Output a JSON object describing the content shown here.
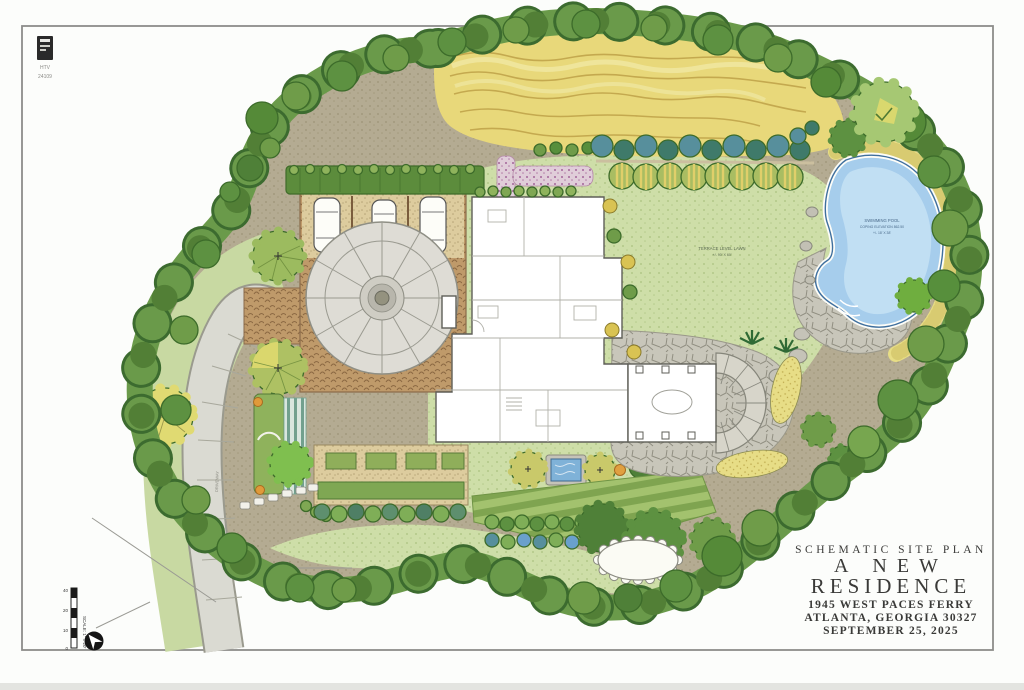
{
  "document": {
    "kind": "hand-rendered schematic landscape site plan",
    "paper_color": "#fcfdfb"
  },
  "stamp": {
    "firm": "HTV",
    "number": "24109"
  },
  "title_block": {
    "kicker": "SCHEMATIC SITE PLAN",
    "title_line1": "A NEW",
    "title_line2": "RESIDENCE",
    "address_line1": "1945 WEST PACES FERRY",
    "address_line2": "ATLANTA, GEORGIA 30327",
    "date": "SEPTEMBER 25, 2025"
  },
  "plan_labels": {
    "pool_line1": "SWIMMING POOL",
    "pool_line2": "COPING ELEVATION 862.50",
    "pool_line3": "+/- 18' X 38'",
    "lawn_line1": "TERRACE LEVEL LAWN",
    "lawn_line2": "+/- 90' X 60'",
    "driveway": "DRIVEWAY"
  },
  "scale_bar": {
    "ticks": [
      "40",
      "20",
      "10",
      "0"
    ],
    "note": "SCALE: 1\" = 20'"
  },
  "colors": {
    "border_tree_green": "#6a9a4a",
    "border_tree_dark": "#3c6b2f",
    "lawn_green": "#cedea8",
    "meadow_yellow": "#e8d87a",
    "pool_water_blue": "#a6cdec",
    "stone_gray": "#c7c5b9",
    "drive_gray": "#dadad2",
    "cobble_tan": "#bf9a6a",
    "ground_tan": "#b4ab92",
    "title_ink": "#3a3a38"
  }
}
